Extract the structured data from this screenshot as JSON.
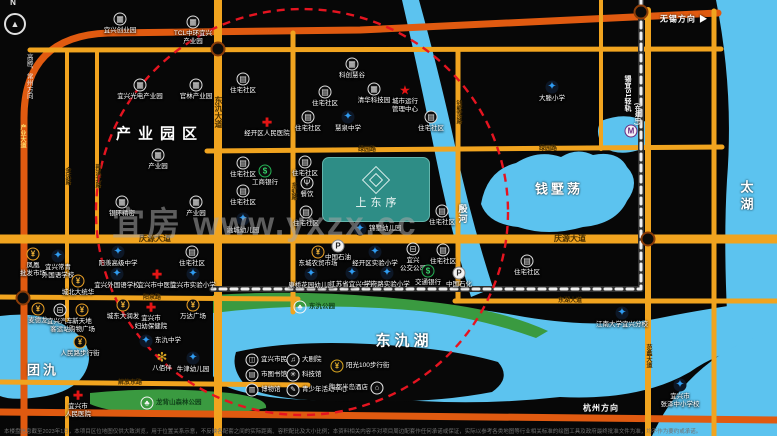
{
  "map": {
    "watermark": "宜房 www.yxzx.cc",
    "compass_label": "N",
    "project": {
      "name": "上东序"
    },
    "disclaimer": "本楼盘信息截至2023年1月，本项目区位地图仅供大致浏览，用于位置关系示意，不反映各配套之间的实际距离、容积配比及大小比例；本资料相关内容不对项目周边配套作任何承诺或保证，实际以参考各类地图等行业相关标准的绘图工具及政府最终批准文件为准，均不作为要约或承诺。",
    "colors": {
      "bg": "#070707",
      "road_yellow": "#f1a41f",
      "road_orange": "#e05a10",
      "water": "#5cc3ef",
      "green": "#3a9a40",
      "peninsula": "#080808",
      "red_dash": "#e51420",
      "project_teal": "#2e8d86",
      "metro_dash": "#f0f0f0"
    },
    "area_labels": [
      {
        "t": "产业园区",
        "x": 160,
        "y": 133,
        "fs": 15,
        "ls": 7
      },
      {
        "t": "团氿",
        "x": 43,
        "y": 369,
        "fs": 13,
        "ls": 3
      },
      {
        "t": "东氿湖",
        "x": 404,
        "y": 340,
        "fs": 15,
        "ls": 4
      },
      {
        "t": "钱墅荡",
        "x": 559,
        "y": 188,
        "fs": 13,
        "ls": 3
      },
      {
        "t": "太湖",
        "x": 746,
        "y": 197,
        "fs": 13,
        "ls": 4,
        "vert": 1
      },
      {
        "t": "殷河",
        "x": 463,
        "y": 214,
        "fs": 9,
        "ls": 1,
        "vert": 1
      },
      {
        "t": "无锡方向 ▶",
        "x": 684,
        "y": 19,
        "fs": 8,
        "ls": 1
      },
      {
        "t": "杭州方向",
        "x": 601,
        "y": 408,
        "fs": 8,
        "ls": 1
      },
      {
        "t": "锡宜S1轻轨",
        "x": 627,
        "y": 93,
        "fs": 7,
        "ls": 0,
        "vert": 1
      },
      {
        "t": "(在建中)",
        "x": 637,
        "y": 114,
        "fs": 6,
        "ls": 0,
        "vert": 1
      }
    ],
    "road_labels": [
      {
        "t": "庆源大道",
        "x": 155,
        "y": 239,
        "fs": 8
      },
      {
        "t": "庆源大道",
        "x": 570,
        "y": 239,
        "fs": 8
      },
      {
        "t": "东氿大道",
        "x": 218,
        "y": 112,
        "fs": 8,
        "vert": 1
      },
      {
        "t": "阳泉路",
        "x": 152,
        "y": 298,
        "fs": 6
      },
      {
        "t": "解放东路",
        "x": 130,
        "y": 383,
        "fs": 6
      },
      {
        "t": "东湖大道",
        "x": 570,
        "y": 301,
        "fs": 6
      },
      {
        "t": "绿园路",
        "x": 367,
        "y": 150,
        "fs": 6
      },
      {
        "t": "绿园路",
        "x": 548,
        "y": 149,
        "fs": 6
      },
      {
        "t": "金达路",
        "x": 67,
        "y": 176,
        "fs": 6,
        "vert": 1
      },
      {
        "t": "荆溪北路",
        "x": 97,
        "y": 176,
        "fs": 6,
        "vert": 1
      },
      {
        "t": "东虹路",
        "x": 293,
        "y": 191,
        "fs": 6,
        "vert": 1
      },
      {
        "t": "钱墅荡路",
        "x": 458,
        "y": 112,
        "fs": 6,
        "vert": 1
      },
      {
        "t": "范蠡大道",
        "x": 648,
        "y": 356,
        "fs": 6,
        "vert": 1
      },
      {
        "t": "产业大道",
        "x": 22,
        "y": 136,
        "fs": 6,
        "vert": 1,
        "tone": "light"
      },
      {
        "t": "高塍、常州方向",
        "x": 28,
        "y": 76,
        "fs": 6.5,
        "vert": 1,
        "tone": "white"
      }
    ],
    "pois": [
      {
        "x": 120,
        "y": 19,
        "t": "ind",
        "l": "宜兴创业园"
      },
      {
        "x": 193,
        "y": 22,
        "t": "ind",
        "l": "TCL中环宜兴\n产业园"
      },
      {
        "x": 140,
        "y": 85,
        "t": "ind",
        "l": "宜兴光电产业园"
      },
      {
        "x": 196,
        "y": 85,
        "t": "ind",
        "l": "官林产业园"
      },
      {
        "x": 243,
        "y": 79,
        "t": "res",
        "l": "住宅社区"
      },
      {
        "x": 158,
        "y": 155,
        "t": "ind",
        "l": "产业园"
      },
      {
        "x": 122,
        "y": 202,
        "t": "ind",
        "l": "银环精密"
      },
      {
        "x": 196,
        "y": 202,
        "t": "ind",
        "l": "产业园"
      },
      {
        "x": 243,
        "y": 163,
        "t": "res",
        "l": "住宅社区"
      },
      {
        "x": 243,
        "y": 191,
        "t": "res",
        "l": "住宅社区"
      },
      {
        "x": 243,
        "y": 219,
        "t": "school",
        "l": "融城幼儿园"
      },
      {
        "x": 352,
        "y": 64,
        "t": "ind",
        "l": "科创慧谷"
      },
      {
        "x": 325,
        "y": 92,
        "t": "res",
        "l": "住宅社区"
      },
      {
        "x": 374,
        "y": 89,
        "t": "ind",
        "l": "清华科技园"
      },
      {
        "x": 405,
        "y": 90,
        "t": "star",
        "l": "城市运行\n管理中心"
      },
      {
        "x": 308,
        "y": 117,
        "t": "res",
        "l": "住宅社区"
      },
      {
        "x": 348,
        "y": 117,
        "t": "school",
        "l": "慧泉中学"
      },
      {
        "x": 267,
        "y": 122,
        "t": "hosp",
        "l": "经开区人民医院"
      },
      {
        "x": 431,
        "y": 117,
        "t": "res",
        "l": "住宅社区"
      },
      {
        "x": 552,
        "y": 87,
        "t": "school",
        "l": "大塍小学"
      },
      {
        "x": 631,
        "y": 131,
        "t": "metro",
        "l": ""
      },
      {
        "x": 305,
        "y": 162,
        "t": "res",
        "l": "住宅社区"
      },
      {
        "x": 265,
        "y": 171,
        "t": "bank",
        "l": "工商银行"
      },
      {
        "x": 307,
        "y": 183,
        "t": "rest",
        "l": "餐饮"
      },
      {
        "x": 306,
        "y": 212,
        "t": "res",
        "l": "住宅社区"
      },
      {
        "x": 360,
        "y": 229,
        "t": "school",
        "l": "锦墅幼儿园",
        "lp": "r"
      },
      {
        "x": 442,
        "y": 211,
        "t": "res",
        "l": "住宅社区"
      },
      {
        "x": 318,
        "y": 252,
        "t": "mall",
        "l": "东城农贸市场"
      },
      {
        "x": 338,
        "y": 246,
        "t": "petrol",
        "l": "中国石油"
      },
      {
        "x": 375,
        "y": 252,
        "t": "school",
        "l": "经开区实验小学"
      },
      {
        "x": 413,
        "y": 249,
        "t": "bus",
        "l": "宜兴\n公交公司"
      },
      {
        "x": 311,
        "y": 274,
        "t": "school",
        "l": "康桥花园幼儿园"
      },
      {
        "x": 352,
        "y": 273,
        "t": "school",
        "l": "江苏省宜兴中学"
      },
      {
        "x": 387,
        "y": 273,
        "t": "school",
        "l": "学府路实验小学"
      },
      {
        "x": 428,
        "y": 271,
        "t": "bank",
        "l": "交通银行"
      },
      {
        "x": 459,
        "y": 273,
        "t": "petrol",
        "l": "中国石化"
      },
      {
        "x": 443,
        "y": 250,
        "t": "res",
        "l": "住宅社区"
      },
      {
        "x": 527,
        "y": 261,
        "t": "res",
        "l": "住宅社区"
      },
      {
        "x": 622,
        "y": 313,
        "t": "school",
        "l": "江南大学宜兴分校"
      },
      {
        "x": 680,
        "y": 385,
        "t": "school",
        "l": "宜兴市\n张泽中小学校"
      },
      {
        "x": 33,
        "y": 254,
        "t": "mall",
        "l": "凤凰\n批发市场"
      },
      {
        "x": 58,
        "y": 256,
        "t": "school",
        "l": "宜兴常青\n外国语学校"
      },
      {
        "x": 118,
        "y": 252,
        "t": "school",
        "l": "阳羡高级中学"
      },
      {
        "x": 117,
        "y": 274,
        "t": "school",
        "l": "宜兴外国语学校"
      },
      {
        "x": 157,
        "y": 274,
        "t": "hosp",
        "l": "宜兴市中医院"
      },
      {
        "x": 193,
        "y": 274,
        "t": "school",
        "l": "宜兴市实验小学"
      },
      {
        "x": 192,
        "y": 252,
        "t": "res",
        "l": "住宅社区"
      },
      {
        "x": 78,
        "y": 281,
        "t": "mall",
        "l": "城北大统华"
      },
      {
        "x": 38,
        "y": 309,
        "t": "mall",
        "l": "麦德龙"
      },
      {
        "x": 60,
        "y": 310,
        "t": "bus",
        "l": "宜兴汽车\n客运站"
      },
      {
        "x": 82,
        "y": 310,
        "t": "mall",
        "l": "新天地\n购物广场"
      },
      {
        "x": 80,
        "y": 342,
        "t": "mall",
        "l": "人民路步行街"
      },
      {
        "x": 123,
        "y": 305,
        "t": "mall",
        "l": "城东大润发"
      },
      {
        "x": 151,
        "y": 307,
        "t": "hosp",
        "l": "宜兴市\n妇幼保健院"
      },
      {
        "x": 193,
        "y": 305,
        "t": "mall",
        "l": "万达广场"
      },
      {
        "x": 146,
        "y": 341,
        "t": "school",
        "l": "东氿中学",
        "lp": "r"
      },
      {
        "x": 162,
        "y": 357,
        "t": "flower",
        "l": "八佰伴"
      },
      {
        "x": 193,
        "y": 358,
        "t": "school",
        "l": "牛津幼儿园"
      },
      {
        "x": 78,
        "y": 395,
        "t": "hosp",
        "l": "宜兴市\n人民医院"
      },
      {
        "x": 147,
        "y": 403,
        "t": "park",
        "l": "龙背山森林公园",
        "lp": "r",
        "dk": 1
      },
      {
        "x": 300,
        "y": 307,
        "t": "park",
        "l": "东氿公园",
        "lp": "r",
        "dk": 1
      },
      {
        "x": 252,
        "y": 360,
        "t": "culture",
        "g": "◫",
        "l": "宜兴市民广场",
        "lp": "r"
      },
      {
        "x": 293,
        "y": 360,
        "t": "culture",
        "g": "♫",
        "l": "大剧院",
        "lp": "r"
      },
      {
        "x": 252,
        "y": 375,
        "t": "culture",
        "g": "▤",
        "l": "市图书馆",
        "lp": "r"
      },
      {
        "x": 293,
        "y": 375,
        "t": "culture",
        "g": "✳",
        "l": "科技馆",
        "lp": "r"
      },
      {
        "x": 252,
        "y": 390,
        "t": "culture",
        "g": "▥",
        "l": "博物馆",
        "lp": "r"
      },
      {
        "x": 293,
        "y": 390,
        "t": "culture",
        "g": "✎",
        "l": "青少年活动中心",
        "lp": "r"
      },
      {
        "x": 337,
        "y": 366,
        "t": "gold",
        "g": "¥",
        "l": "阳光100步行街",
        "lp": "r"
      },
      {
        "x": 377,
        "y": 388,
        "t": "culture",
        "g": "⌂",
        "l": "陶都半岛酒店",
        "lp": "l"
      }
    ],
    "geometry": {
      "water": [
        "M716,0 Q734,90 727,180 Q721,280 736,436 L777,436 L777,0 Z",
        "M0,316 Q45,310 72,330 Q95,346 87,368 Q78,392 40,397 Q12,401 0,396 Z",
        "M481,204 Q487,170 516,163 Q538,149 561,157 Q577,147 593,155 Q618,150 627,167 Q641,182 627,201 Q616,224 583,227 Q548,237 518,227 Q488,224 481,204 Z",
        "M601,121 Q626,111 646,122 Q656,136 644,148 Q620,158 603,147 Q594,132 601,121 Z",
        "M402,0 L419,0 Q441,80 456,150 Q471,220 493,288 L471,297 Q450,228 436,158 Q420,78 402,0 Z",
        "M213,312 Q265,299 330,302 Q430,299 525,317 Q605,330 665,317 Q710,308 777,299 L777,338 Q720,350 690,372 Q640,401 560,397 Q470,407 380,398 Q300,404 252,394 Q220,388 213,376 Z",
        "M652,436 Q675,385 720,355 Q748,338 777,330 L777,436 Z"
      ],
      "green": [
        "M213,295 Q320,288 440,303 Q505,311 548,331 L536,338 Q480,318 420,311 Q310,301 213,313 Z",
        "M90,393 Q160,386 230,393 Q268,398 266,408 Q230,416 160,414 Q110,413 90,404 Z"
      ],
      "peninsula": [
        "M236,352 Q290,340 370,344 Q450,348 498,362 Q512,378 492,392 Q430,404 350,401 Q280,402 248,388 Q230,370 236,352 Z"
      ],
      "roads": [
        {
          "d": "M24,436 L24,118 Q24,36 108,33 L360,30 L718,13",
          "c": "o",
          "w": 7
        },
        {
          "d": "M0,412 L300,415 L777,420",
          "c": "o",
          "w": 7
        },
        {
          "d": "M30,50 L721,49",
          "c": "y",
          "w": 5
        },
        {
          "d": "M207,151 L722,147",
          "c": "y",
          "w": 5
        },
        {
          "d": "M0,239 L777,239",
          "c": "y",
          "w": 9
        },
        {
          "d": "M0,297 L298,299",
          "c": "y",
          "w": 5
        },
        {
          "d": "M0,382 L308,385",
          "c": "y",
          "w": 5
        },
        {
          "d": "M455,301 L777,301",
          "c": "y",
          "w": 5
        },
        {
          "d": "M67,50 L67,320",
          "c": "y",
          "w": 4
        },
        {
          "d": "M67,398 L67,436",
          "c": "y",
          "w": 4
        },
        {
          "d": "M97,50 L97,239",
          "c": "y",
          "w": 4
        },
        {
          "d": "M218,0 L218,436",
          "c": "y",
          "w": 8
        },
        {
          "d": "M293,33 L293,312",
          "c": "y",
          "w": 5
        },
        {
          "d": "M458,50 L458,299",
          "c": "y",
          "w": 5
        },
        {
          "d": "M648,10 L648,436",
          "c": "y",
          "w": 6
        },
        {
          "d": "M601,0 L601,149",
          "c": "y",
          "w": 4
        },
        {
          "d": "M714,11 L714,436",
          "c": "y",
          "w": 5
        }
      ],
      "metro": "M641,0 L641,289 L212,289",
      "red_circle": {
        "cx": 302,
        "cy": 212,
        "rx": 206,
        "ry": 203
      },
      "junctions": [
        [
          218,
          49
        ],
        [
          648,
          239
        ],
        [
          23,
          298
        ],
        [
          641,
          12
        ]
      ]
    }
  }
}
